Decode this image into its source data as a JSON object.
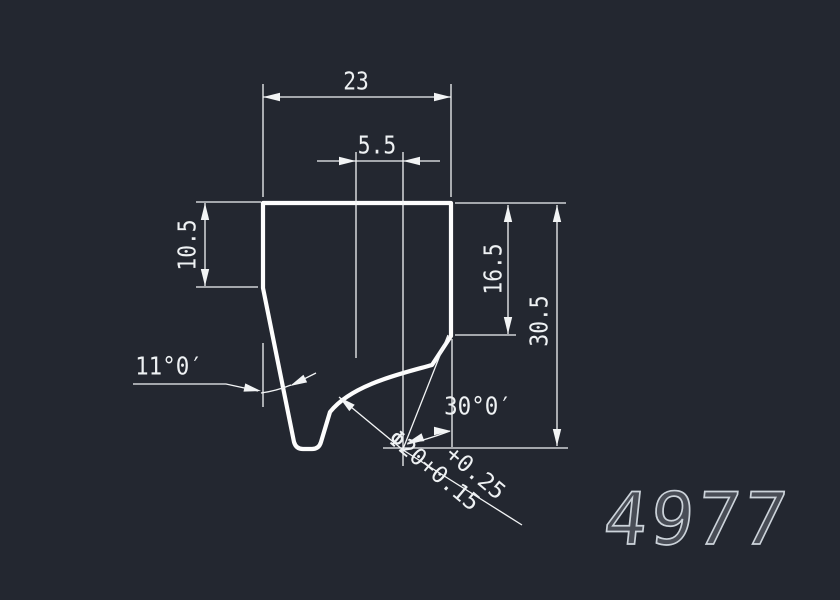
{
  "canvas": {
    "background": "#232730",
    "line_color": "#f2f4f5",
    "outline_color": "#fdfdfd",
    "text_color": "#eef1f3",
    "part_number_color": "#ccd3da"
  },
  "part_number": "4977",
  "dimensions": {
    "top_width": "23",
    "slot_offset": "5.5",
    "left_depth": "10.5",
    "right_depth": "16.5",
    "overall_height": "30.5"
  },
  "angles": {
    "left": "11°0′",
    "right": "30°0′"
  },
  "diameter_callout": {
    "upper_tolerance": "+0.25",
    "main": "Φ20+0.15"
  }
}
